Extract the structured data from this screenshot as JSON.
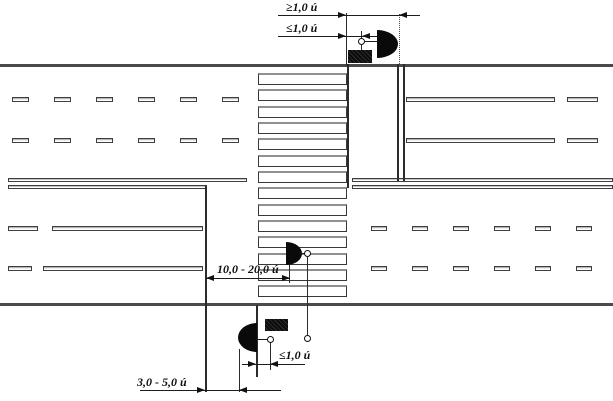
{
  "diagram": {
    "name": "pedestrian-crossing-plan",
    "dimension_labels": {
      "top_outer": "≥1,0 ú",
      "top_inner": "≤1,0 ú",
      "middle": "10,0 - 20,0 ú",
      "bottom_inner": "≤1,0 ú",
      "bottom_outer": "3,0 - 5,0 ú"
    },
    "symbols": {
      "luminaire": "streetlight-half-circle-symbol",
      "sign": "filled-rectangle-sign-symbol",
      "pole": "open-circle-pole-symbol"
    },
    "colors": {
      "line": "#2b2b2b",
      "road_edge": "#4a4a4a",
      "symbol_fill": "#0a0a0a",
      "background": "#ffffff"
    }
  }
}
